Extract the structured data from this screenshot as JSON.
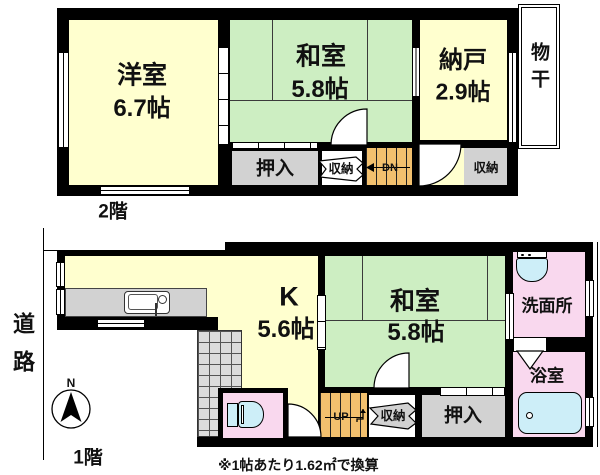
{
  "plan": {
    "floor2": {
      "floor_label": "2階",
      "rooms": {
        "western_room": {
          "name": "洋室",
          "size": "6.7帖"
        },
        "tatami_room": {
          "name": "和室",
          "size": "5.8帖"
        },
        "storage_room": {
          "name": "納戸",
          "size": "2.9帖"
        },
        "drying_area": {
          "name": "物干"
        },
        "closet": {
          "name": "押入"
        },
        "storage_mid": {
          "name": "収納"
        },
        "storage_right": {
          "name": "収納"
        },
        "stairs_down": {
          "label": "DN"
        }
      }
    },
    "floor1": {
      "floor_label": "1階",
      "rooms": {
        "kitchen": {
          "name": "K",
          "size": "5.6帖"
        },
        "tatami_room": {
          "name": "和室",
          "size": "5.8帖"
        },
        "washroom": {
          "name": "洗面所"
        },
        "bathroom": {
          "name": "浴室"
        },
        "closet": {
          "name": "押入"
        },
        "storage": {
          "name": "収納"
        },
        "stairs_up": {
          "label": "UP"
        }
      }
    },
    "road_label": "道路",
    "compass_north_label": "N",
    "footnote": "※1帖あたり1.62㎡で換算"
  },
  "colors": {
    "room_yellow": "#ffffcf",
    "room_green": "#cdeec2",
    "room_pink": "#f9d8ee",
    "closet_gray": "#d2d2d2",
    "stairs_orange": "#f2c06e",
    "fixture_blue": "#cdeef8",
    "wall_black": "#000000"
  }
}
